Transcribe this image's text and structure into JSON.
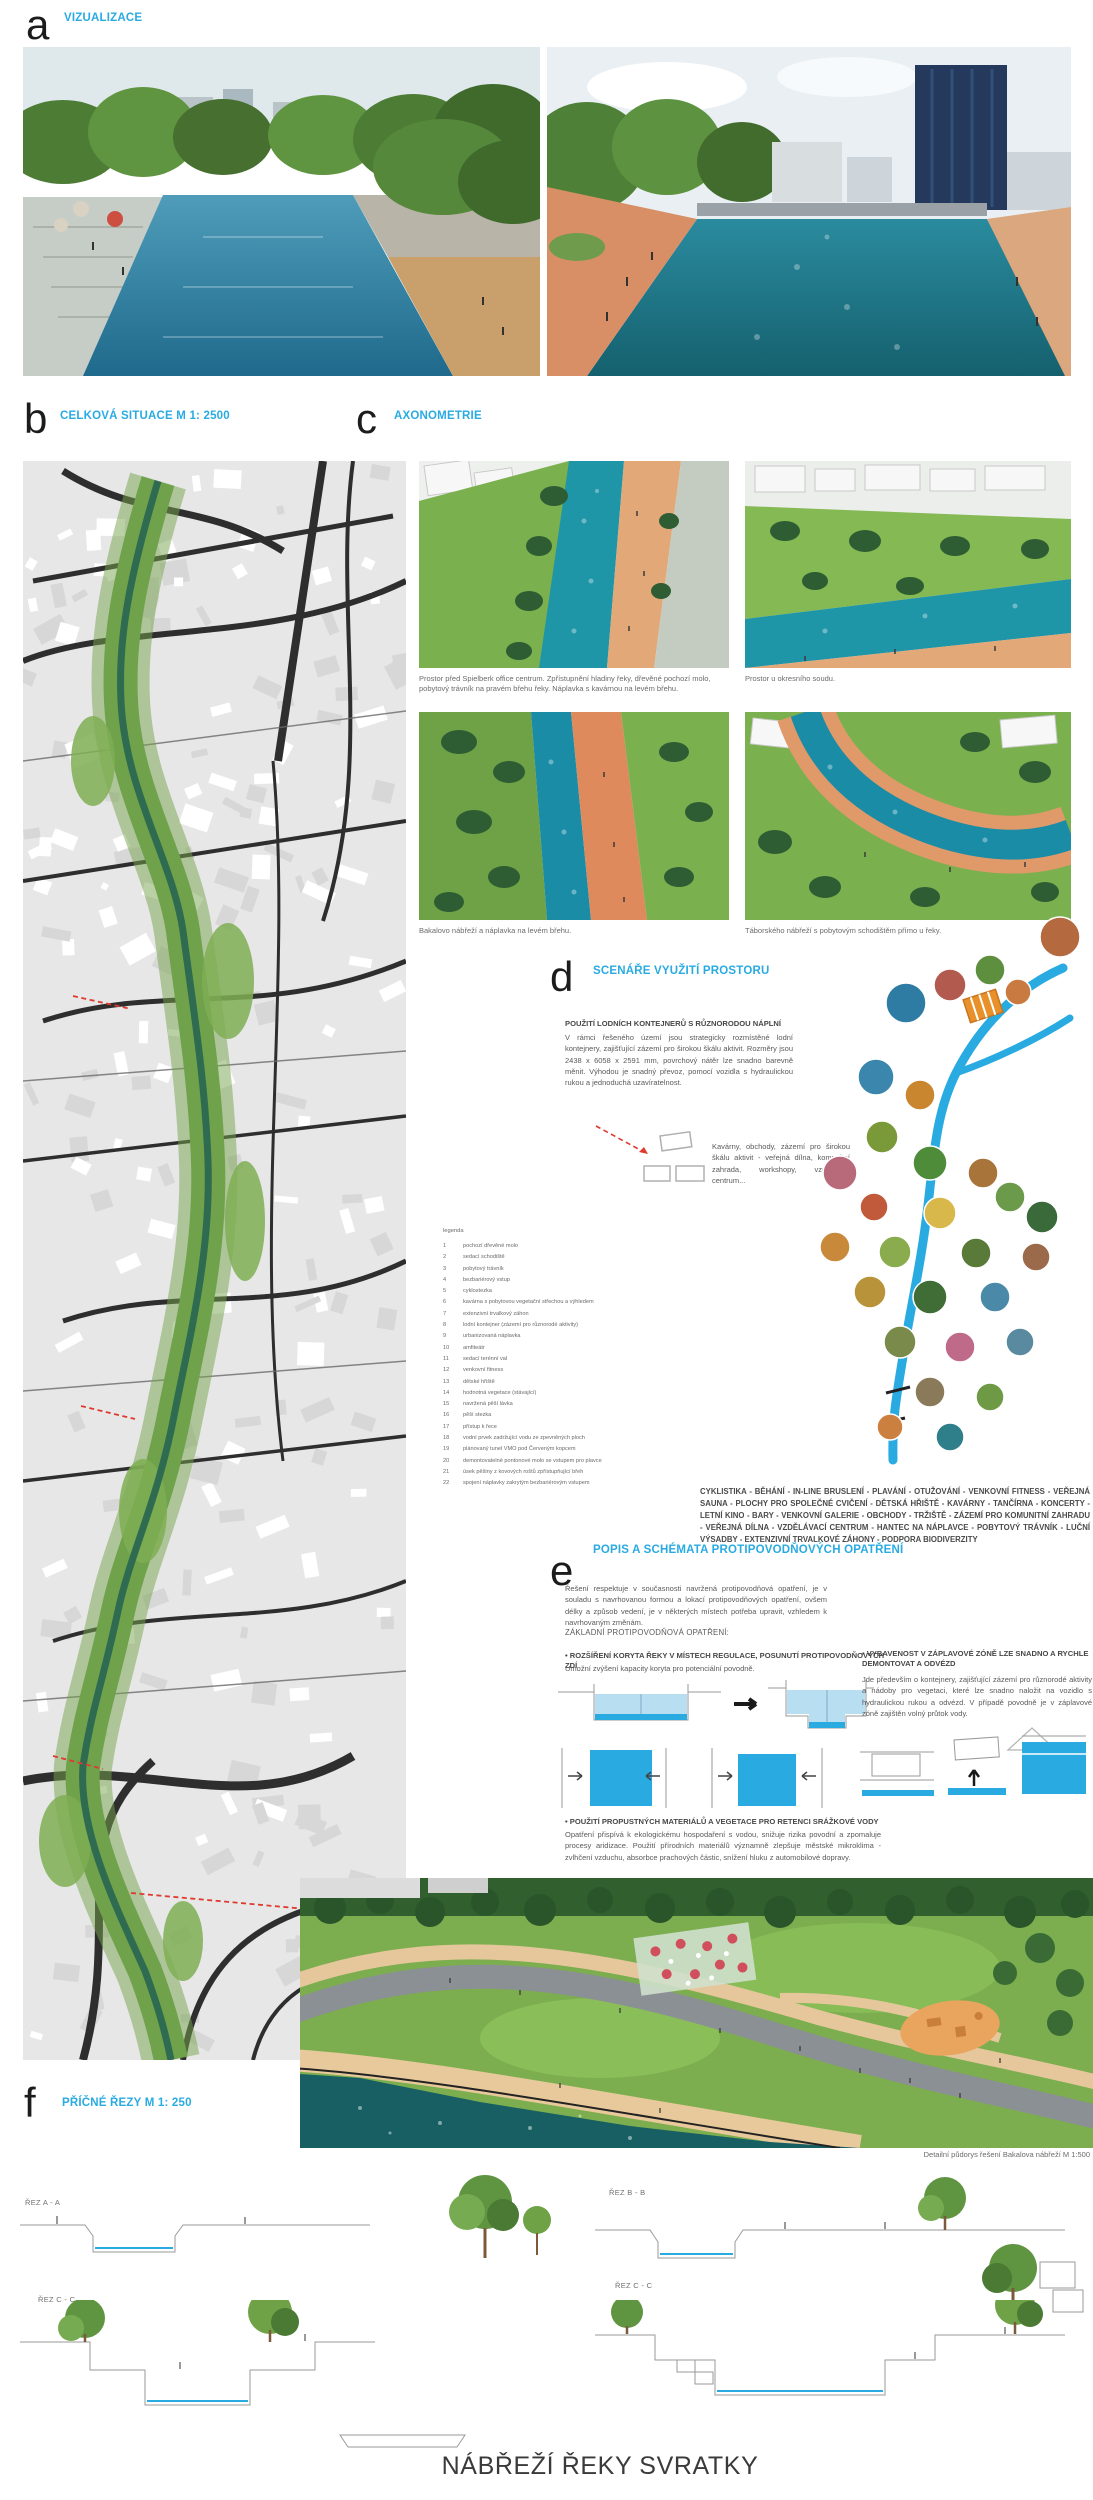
{
  "board_title": "NÁBŘEŽÍ ŘEKY SVRATKY",
  "accent_color": "#29abe2",
  "sections": {
    "a": {
      "letter": "a",
      "title": "VIZUALIZACE"
    },
    "b": {
      "letter": "b",
      "title": "CELKOVÁ SITUACE M 1: 2500"
    },
    "c": {
      "letter": "c",
      "title": "AXONOMETRIE",
      "captions": [
        "Prostor před Spielberk office centrum. Zpřístupnění hladiny řeky, dřevěné pochozí molo, pobytový trávník na pravém břehu řeky. Náplavka s kavárnou na levém břehu.",
        "Prostor u okresního soudu.",
        "Bakalovo nábřeží a náplavka na levém břehu.",
        "Táborského nábřeží s pobytovým schodištěm přímo u řeky."
      ]
    },
    "d": {
      "letter": "d",
      "title": "SCENÁŘE VYUŽITÍ PROSTORU",
      "subheading": "POUŽITÍ LODNÍCH KONTEJNERŮ S RŮZNORODOU NÁPLNÍ",
      "paragraph": "V rámci řešeného území jsou strategicky rozmístěné lodní kontejnery, zajišťující zázemí pro širokou škálu aktivit. Rozměry jsou 2438 x 6058 x 2591 mm, povrchový nátěr lze snadno barevně měnit. Výhodou je snadný převoz, pomocí vozidla s hydraulickou rukou a jednoduchá uzavíratelnost.",
      "container_caption": "Kavárny, obchody, zázemí pro širokou škálu aktivit - veřejná dílna, komunitní zahrada, workshopy, vzdělávací centrum...",
      "program_list": "CYKLISTIKA - BĚHÁNÍ - IN-LINE BRUSLENÍ - PLAVÁNÍ - OTUŽOVÁNÍ - VENKOVNÍ FITNESS - VEŘEJNÁ SAUNA - PLOCHY PRO SPOLEČNÉ CVIČENÍ - DĚTSKÁ HŘIŠTĚ - KAVÁRNY - TANČÍRNA - KONCERTY - LETNÍ KINO - BARY - VENKOVNÍ GALERIE - OBCHODY - TRŽIŠTĚ - ZÁZEMÍ PRO KOMUNITNÍ ZAHRADU - VEŘEJNÁ DÍLNA - VZDĚLÁVACÍ CENTRUM - HANTEC NA NÁPLAVCE - POBYTOVÝ TRÁVNÍK - LUČNÍ VÝSADBY - EXTENZIVNÍ TRVALKOVÉ ZÁHONY - PODPORA BIODIVERZITY"
    },
    "e": {
      "letter": "e",
      "title": "POPIS A SCHÉMATA PROTIPOVODŇOVÝCH OPATŘENÍ",
      "intro": "Řešení respektuje v současnosti navržená protipovodňová opatření, je v souladu s navrhovanou formou a lokací protipovodňových opatření, ovšem délky a způsob vedení, je v některých místech potřeba upravit, vzhledem k navrhovaným změnám.",
      "basics_label": "ZÁKLADNÍ PROTIPOVODŇOVÁ OPATŘENÍ:",
      "measures": [
        {
          "heading": "ROZŠÍŘENÍ KORYTA ŘEKY V MÍSTECH REGULACE, POSUNUTÍ PROTIPOVODŇOVÝCH ZDÍ",
          "text": "Umožní zvýšení kapacity koryta pro potenciální povodně."
        },
        {
          "heading": "VYBAVENOST V ZÁPLAVOVÉ ZÓNĚ LZE SNADNO A RYCHLE DEMONTOVAT A ODVÉZD",
          "text": "Jde především o kontejnery, zajišťující zázemí pro různorodé aktivity a nádoby pro vegetaci, které lze snadno naložit na vozidlo s hydraulickou rukou a odvézd. V případě povodně je v záplavové zóně zajištěn volný průtok vody."
        },
        {
          "heading": "POUŽITÍ PROPUSTNÝCH MATERIÁLŮ A VEGETACE PRO RETENCI SRÁŽKOVÉ VODY",
          "text": "Opatření přispívá k ekologickému hospodaření s vodou, snižuje rizika povodní a zpomaluje procesy aridizace. Použití přírodních materiálů významně zlepšuje městské mikroklima - zvlhčení vzduchu, absorbce prachových částic, snížení hluku z automobilové dopravy."
        }
      ]
    },
    "f": {
      "letter": "f",
      "title": "PŘÍČNÉ ŘEZY M 1: 250",
      "detail_caption": "Detailní půdorys řešení Bakalova nábřeží M 1:500",
      "section_labels": [
        "ŘEZ A - A",
        "ŘEZ B - B",
        "ŘEZ C - C",
        "ŘEZ C - C"
      ]
    }
  },
  "legend": {
    "title": "legenda",
    "items": [
      {
        "n": "1",
        "label": "pochozí dřevěné molo"
      },
      {
        "n": "2",
        "label": "sedací schodiště"
      },
      {
        "n": "3",
        "label": "pobytový trávník"
      },
      {
        "n": "4",
        "label": "bezbariérový vstup"
      },
      {
        "n": "5",
        "label": "cyklostezka"
      },
      {
        "n": "6",
        "label": "kavárna s pobytovou vegetační střechou a výhledem"
      },
      {
        "n": "7",
        "label": "extenzivní trvalkový záhon"
      },
      {
        "n": "8",
        "label": "lodní kontejner (zázemí pro různorodé aktivity)"
      },
      {
        "n": "9",
        "label": "urbanizovaná náplavka"
      },
      {
        "n": "10",
        "label": "amfiteátr"
      },
      {
        "n": "11",
        "label": "sedací terénní val"
      },
      {
        "n": "12",
        "label": "venkovní fitness"
      },
      {
        "n": "13",
        "label": "dětské hřiště"
      },
      {
        "n": "14",
        "label": "hodnotná vegetace (stávající)"
      },
      {
        "n": "15",
        "label": "navržená pěší lávka"
      },
      {
        "n": "16",
        "label": "pěší stezka"
      },
      {
        "n": "17",
        "label": "přístup k řece"
      },
      {
        "n": "18",
        "label": "vodní prvek zadržující vodu ze zpevněných ploch"
      },
      {
        "n": "19",
        "label": "plánovaný tunel VMO pod Červeným kopcem"
      },
      {
        "n": "20",
        "label": "demontovatelné pontonové molo se vstupem pro plavce"
      },
      {
        "n": "21",
        "label": "úsek pěšiny z kovových roštů zpřístupňující břeh"
      },
      {
        "n": "22",
        "label": "spojení náplavky zakrytým bezbariérovým vstupem"
      }
    ]
  },
  "scenario": {
    "river_color": "#29abe2",
    "container_icon_color": "#e8912a",
    "circles": [
      {
        "x": 128,
        "y": 88,
        "r": 20,
        "color": "#2e7ca3"
      },
      {
        "x": 172,
        "y": 70,
        "r": 16,
        "color": "#b35a4e"
      },
      {
        "x": 212,
        "y": 55,
        "r": 15,
        "color": "#5e8f3f"
      },
      {
        "x": 240,
        "y": 77,
        "r": 13,
        "color": "#c97a40"
      },
      {
        "x": 282,
        "y": 22,
        "r": 20,
        "color": "#b5693f"
      },
      {
        "x": 98,
        "y": 162,
        "r": 18,
        "color": "#3a86ad"
      },
      {
        "x": 142,
        "y": 180,
        "r": 15,
        "color": "#c9862f"
      },
      {
        "x": 104,
        "y": 222,
        "r": 16,
        "color": "#7a9a3a"
      },
      {
        "x": 62,
        "y": 258,
        "r": 17,
        "color": "#b86a7a"
      },
      {
        "x": 152,
        "y": 248,
        "r": 17,
        "color": "#4e8c3a"
      },
      {
        "x": 205,
        "y": 258,
        "r": 15,
        "color": "#a8743a"
      },
      {
        "x": 96,
        "y": 292,
        "r": 14,
        "color": "#c05a3a"
      },
      {
        "x": 162,
        "y": 298,
        "r": 16,
        "color": "#d8b84a"
      },
      {
        "x": 232,
        "y": 282,
        "r": 15,
        "color": "#6a9a4a"
      },
      {
        "x": 264,
        "y": 302,
        "r": 16,
        "color": "#3a6a3a"
      },
      {
        "x": 57,
        "y": 332,
        "r": 15,
        "color": "#c88a3a"
      },
      {
        "x": 117,
        "y": 337,
        "r": 16,
        "color": "#8aac4e"
      },
      {
        "x": 198,
        "y": 338,
        "r": 15,
        "color": "#5a7a3a"
      },
      {
        "x": 258,
        "y": 342,
        "r": 14,
        "color": "#9a6a4a"
      },
      {
        "x": 92,
        "y": 377,
        "r": 16,
        "color": "#b8933a"
      },
      {
        "x": 152,
        "y": 382,
        "r": 17,
        "color": "#3f6d35"
      },
      {
        "x": 217,
        "y": 382,
        "r": 15,
        "color": "#4a8aa8"
      },
      {
        "x": 122,
        "y": 427,
        "r": 16,
        "color": "#7a8a4a"
      },
      {
        "x": 182,
        "y": 432,
        "r": 15,
        "color": "#c06a8a"
      },
      {
        "x": 242,
        "y": 427,
        "r": 14,
        "color": "#5a8aa0"
      },
      {
        "x": 152,
        "y": 477,
        "r": 15,
        "color": "#8a7a5a"
      },
      {
        "x": 212,
        "y": 482,
        "r": 14,
        "color": "#6f9a45"
      },
      {
        "x": 112,
        "y": 512,
        "r": 13,
        "color": "#cc8040"
      },
      {
        "x": 172,
        "y": 522,
        "r": 14,
        "color": "#2e7f8a"
      }
    ]
  }
}
